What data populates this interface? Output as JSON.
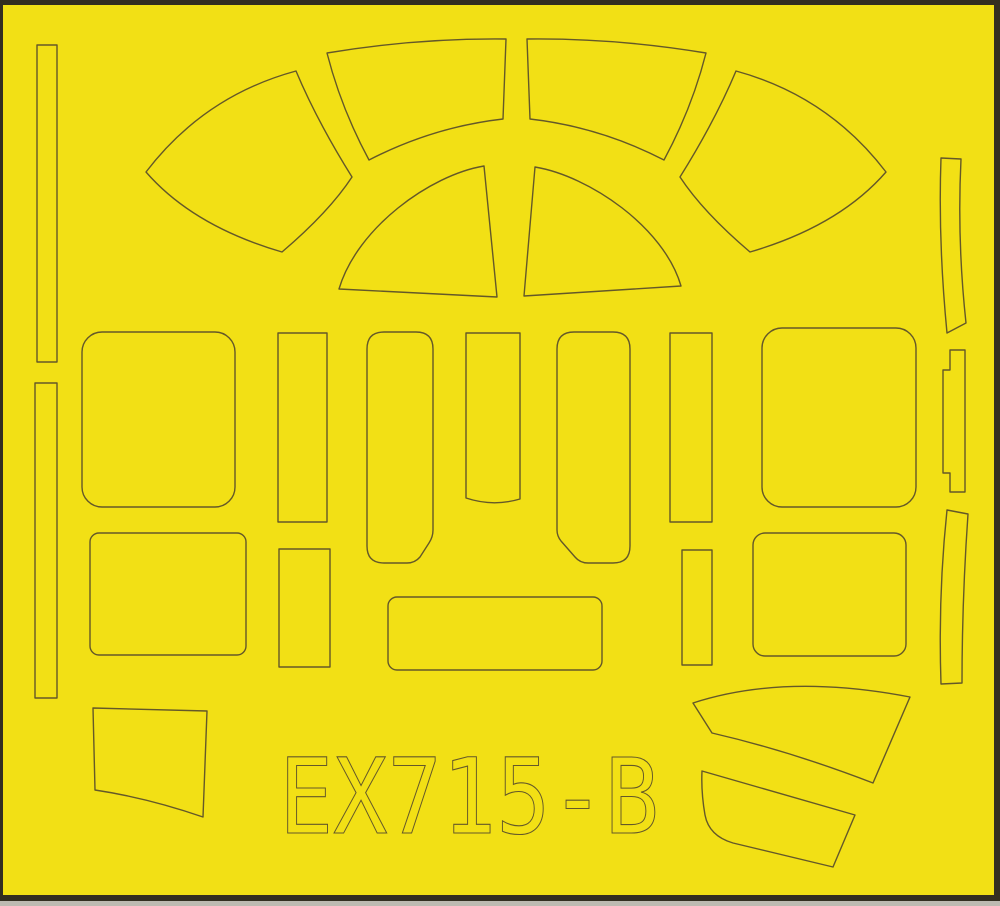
{
  "sheet": {
    "code": "EX715-B",
    "kind": "die-cut canopy paint mask sheet",
    "colors": {
      "tape_yellow": "#F2E015",
      "cut_line": "#645829",
      "edge_dark": "#332E20",
      "edge_light": "#BDBAB1"
    },
    "pieces": [
      "edge-strip-left-upper",
      "edge-strip-left-lower",
      "canopy-wedge-left",
      "canopy-wedge-right",
      "canopy-top-panel-left",
      "canopy-top-panel-right",
      "windscreen-dome-left",
      "windscreen-dome-right",
      "window-panel-front-left",
      "pillar-strip-upper-left",
      "center-panel-left",
      "center-strip",
      "center-panel-right",
      "pillar-strip-upper-right",
      "window-panel-front-right",
      "edge-strip-right-curved-top",
      "edge-strip-right-notched",
      "edge-strip-right-curved-bottom",
      "window-panel-rear-left",
      "pillar-strip-lower-left",
      "lower-center-panel",
      "pillar-strip-lower-right",
      "window-panel-rear-right",
      "corner-panel-bottom-left",
      "curved-band-upper",
      "curved-band-lower"
    ]
  }
}
